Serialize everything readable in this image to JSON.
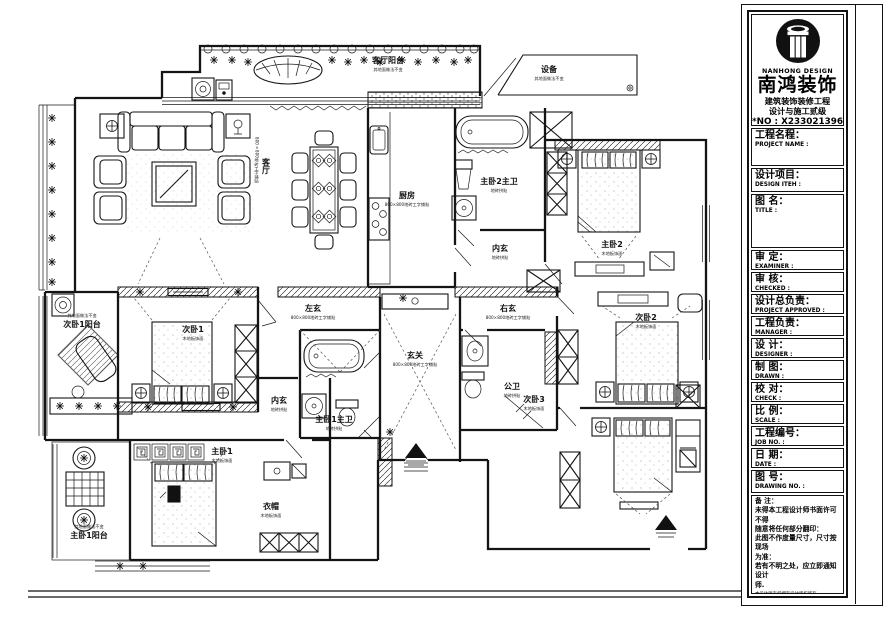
{
  "brand": {
    "logo_en": "NANHONG DESIGN",
    "logo_zh": "南鸿装饰",
    "cert_line1": "建筑装饰装修工程",
    "cert_line2": "设计与施工贰级",
    "cert_no": "*NO : X233021396"
  },
  "titleblock": {
    "fields": [
      {
        "zh": "工程名程：",
        "en": "PROJECT NAME :"
      },
      {
        "zh": "设计项目：",
        "en": "DESIGN ITEH :"
      },
      {
        "zh": "图 名：",
        "en": "TITLE :"
      },
      {
        "zh": "审  定：",
        "en": "EXAMINER :"
      },
      {
        "zh": "审  核：",
        "en": "CHECKED :"
      },
      {
        "zh": "设计总负责：",
        "en": "PROJECT APPROVED :"
      },
      {
        "zh": "工程负责：",
        "en": "MANAGER :"
      },
      {
        "zh": "设  计：",
        "en": "DESIGNER :"
      },
      {
        "zh": "制  图：",
        "en": "DRAWN :"
      },
      {
        "zh": "校  对：",
        "en": "CHECK :"
      },
      {
        "zh": "比  例：",
        "en": "SCALE :"
      },
      {
        "zh": "工程编号：",
        "en": "JOB  NO. :"
      },
      {
        "zh": "日  期：",
        "en": "DATE :"
      },
      {
        "zh": "图  号：",
        "en": "DRAWING NO. :"
      }
    ],
    "notes_title": "备 注：",
    "notes": [
      "未得本工程设计师书面许可不得",
      "随意将任何部分翻印：",
      "此图不作度量尺寸，尺寸按现场",
      "为准：",
      "若有不明之处，应立即通知设计",
      "师."
    ],
    "notes_fine": "本设计师有权拥有设计版权所有",
    "phone": "免费咨询电话:400 8383 168"
  },
  "rooms": [
    {
      "name": "客厅阳台",
      "sub": "其地面做法不变"
    },
    {
      "name": "设备",
      "sub": "其地面做法不变"
    },
    {
      "name": "厨房",
      "sub": "800×800地砖工字铺贴"
    },
    {
      "name": "主卧2主卫",
      "sub": "地砖拼贴"
    },
    {
      "name": "主卧2",
      "sub": "木地板饰面"
    },
    {
      "name": "客厅",
      "sub": "800×800地砖工字铺贴"
    },
    {
      "name": "左玄",
      "sub": "800×800地砖工字铺贴"
    },
    {
      "name": "右玄",
      "sub": "800×800地砖工字铺贴"
    },
    {
      "name": "玄关",
      "sub": "800×800地砖工字铺贴"
    },
    {
      "name": "内玄",
      "sub": "地砖拼贴"
    },
    {
      "name": "公卫",
      "sub": "地砖拼贴"
    },
    {
      "name": "次卧2",
      "sub": "木地板饰面"
    },
    {
      "name": "次卧3",
      "sub": "木地板饰面"
    },
    {
      "name": "次卧1阳台",
      "sub": "其地面做法不变"
    },
    {
      "name": "次卧1",
      "sub": "木地板饰面"
    },
    {
      "name": "内玄",
      "sub": "地砖拼贴"
    },
    {
      "name": "主卧1主卫",
      "sub": "地砖拼贴"
    },
    {
      "name": "主卧1",
      "sub": "木地板饰面"
    },
    {
      "name": "衣帽",
      "sub": "木地板饰面"
    },
    {
      "name": "主卧1阳台",
      "sub": "其地面做法不变"
    }
  ]
}
